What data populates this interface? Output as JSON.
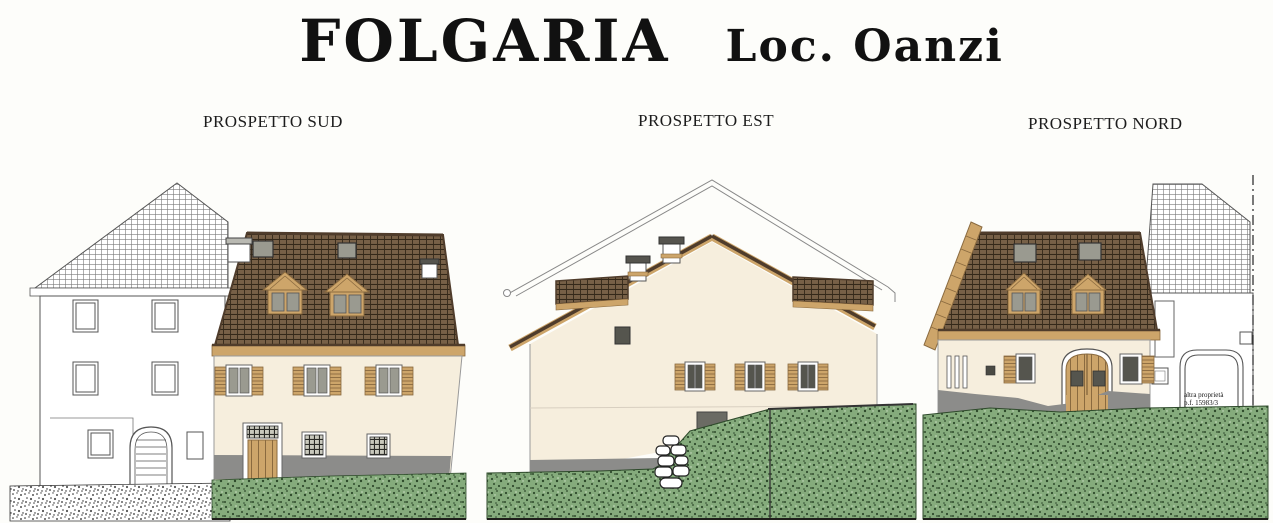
{
  "sheet": {
    "title_main": "FOLGARIA",
    "title_location": "Loc. Oanzi"
  },
  "elevations": {
    "sud": {
      "label": "PROSPETTO SUD"
    },
    "est": {
      "label": "PROSPETTO EST"
    },
    "nord": {
      "label": "PROSPETTO NORD"
    }
  },
  "annotations": {
    "neighbor_property_line1": "altra proprietà",
    "neighbor_property_line2": "p.f. 15983/3"
  },
  "colors": {
    "paper": "#fdfdfa",
    "ink": "#111111",
    "outline": "#55544e",
    "roof-base": "#776047",
    "roof-grid": "#342819",
    "roof-edge": "#4f3c2b",
    "wood": "#cda56a",
    "wood-dark": "#8a6a3f",
    "facade": "#f6eedd",
    "glass": "#9a9a90",
    "glass-dark": "#55554e",
    "plinth": "#8c8c8a",
    "grass": "#85ab7c",
    "grass-dot": "#2e4a2b",
    "stone-white": "#ffffff"
  }
}
